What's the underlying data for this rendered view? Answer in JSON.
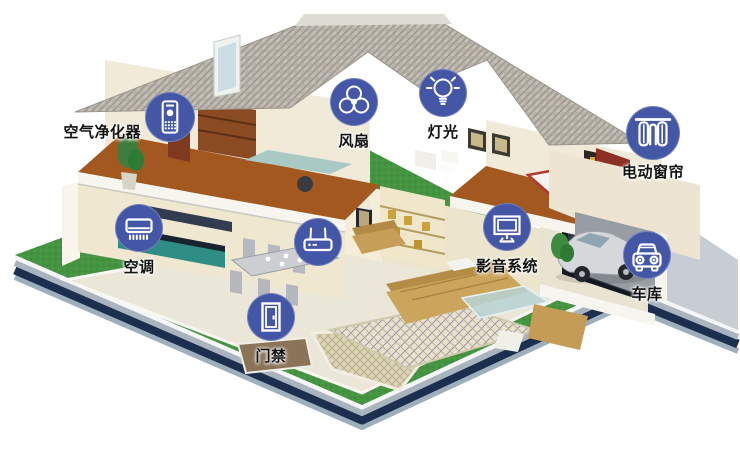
{
  "colors": {
    "icon_circle": "#4456a6",
    "icon_glyph": "#ffffff",
    "label": "#111111",
    "grass": "#459441",
    "slab_navy": "#1d2f4f",
    "roof": "#b9b4ab",
    "upper_floor": "#a2581f",
    "wall_cream": "#efe7d0"
  },
  "hotspots": [
    {
      "id": "air-purifier",
      "label": "空气净化器",
      "icon": "air-purifier-icon"
    },
    {
      "id": "fan",
      "label": "风扇",
      "icon": "fan-icon"
    },
    {
      "id": "light",
      "label": "灯光",
      "icon": "light-bulb-icon"
    },
    {
      "id": "curtain",
      "label": "电动窗帘",
      "icon": "curtain-icon"
    },
    {
      "id": "ac",
      "label": "空调",
      "icon": "air-conditioner-icon"
    },
    {
      "id": "router",
      "label": "",
      "icon": "router-icon"
    },
    {
      "id": "av-system",
      "label": "影音系统",
      "icon": "monitor-icon"
    },
    {
      "id": "garage",
      "label": "车库",
      "icon": "car-icon"
    },
    {
      "id": "door-access",
      "label": "门禁",
      "icon": "door-icon"
    }
  ]
}
